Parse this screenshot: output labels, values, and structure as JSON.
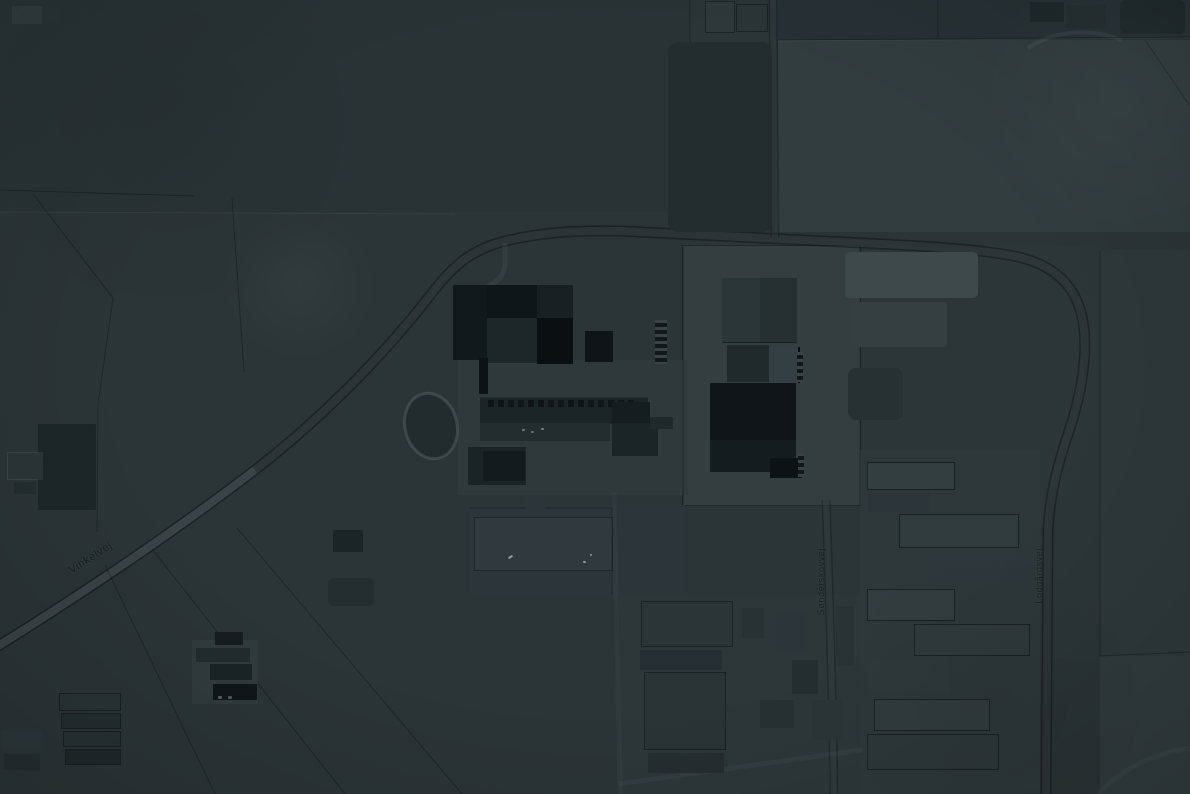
{
  "map": {
    "description": "Dimmed satellite aerial view of a Danish industrial factory complex surrounded by farmland, farms and rows of agricultural barns",
    "road_labels": [
      {
        "id": "vinkelvej",
        "text": "Vinkelvej",
        "orientation": "diagonal"
      },
      {
        "id": "south-road",
        "text": "Sønderskovvej",
        "orientation": "vertical"
      },
      {
        "id": "east-road",
        "text": "Lodgårdsvej",
        "orientation": "vertical"
      }
    ],
    "palette": {
      "field_base": "#2b3437",
      "field_dark": "#273134",
      "field_light": "#323d40",
      "factory_pad": "#343e41",
      "building_darkest": "#0a0f12",
      "building_dark": "#151c1f",
      "building_mid": "#232d30",
      "building_light": "#3e494c",
      "road_fill": "#4b585c",
      "road_casing": "#0c1113",
      "label_color": "#141a1c"
    }
  }
}
